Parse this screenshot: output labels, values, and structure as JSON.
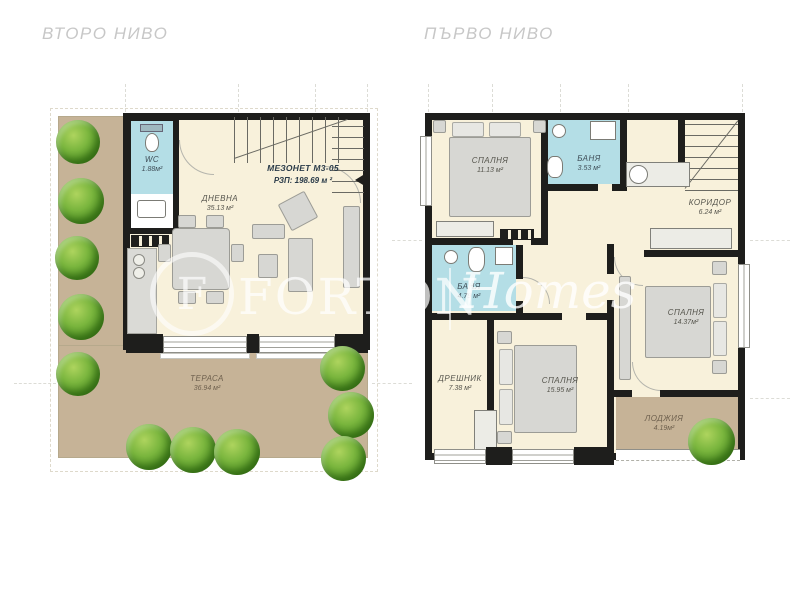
{
  "colors": {
    "wall": "#1e1e1c",
    "floor_cream": "#f8f1db",
    "bathroom_blue": "#b4dee6",
    "terrace_tan": "#c6b397",
    "furniture_gray": "#d7d7d3",
    "bush_green": "#559427",
    "title_gray": "#c7c7c7",
    "label_dark": "#55544c",
    "unit_navy": "#2a3b49"
  },
  "plans": [
    {
      "title": "ВТОРО НИВО",
      "unit": {
        "label": "МЕЗОНЕТ М3-05",
        "area": "РЗП: 198.69 м ²"
      },
      "rooms": [
        {
          "name": "WC",
          "area": "1.88м²"
        },
        {
          "name": "ДНЕВНА",
          "area": "35.13 м²"
        },
        {
          "name": "ТЕРАСА",
          "area": "36.94 м²"
        }
      ]
    },
    {
      "title": "ПЪРВО НИВО",
      "rooms": [
        {
          "name": "СПАЛНЯ",
          "area": "11.13 м²"
        },
        {
          "name": "БАНЯ",
          "area": "3.53 м²"
        },
        {
          "name": "КОРИДОР",
          "area": "6.24 м²"
        },
        {
          "name": "БАНЯ",
          "area": "4.79 м²"
        },
        {
          "name": "СПАЛНЯ",
          "area": "14.37м²"
        },
        {
          "name": "ДРЕШНИК",
          "area": "7.38 м²"
        },
        {
          "name": "СПАЛНЯ",
          "area": "15.95 м²"
        },
        {
          "name": "ЛОДЖИЯ",
          "area": "4.19м²"
        }
      ]
    }
  ],
  "watermark": {
    "logo": "F",
    "name": "FORTON",
    "suffix": "Homes"
  }
}
